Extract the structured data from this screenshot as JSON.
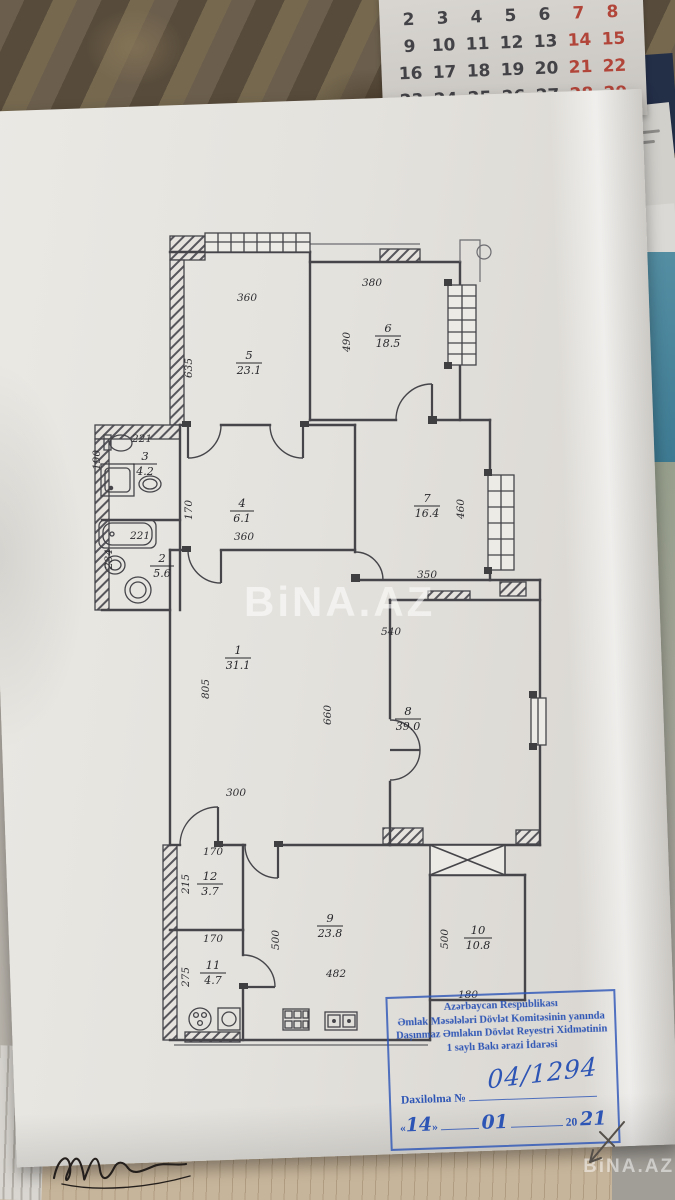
{
  "calendar": {
    "weeks": [
      [
        {
          "t": "2",
          "r": false
        },
        {
          "t": "3",
          "r": false
        },
        {
          "t": "4",
          "r": false
        },
        {
          "t": "5",
          "r": false
        },
        {
          "t": "6",
          "r": false
        },
        {
          "t": "7",
          "r": true
        },
        {
          "t": "8",
          "r": true
        }
      ],
      [
        {
          "t": "9",
          "r": false
        },
        {
          "t": "10",
          "r": false
        },
        {
          "t": "11",
          "r": false
        },
        {
          "t": "12",
          "r": false
        },
        {
          "t": "13",
          "r": false
        },
        {
          "t": "14",
          "r": true
        },
        {
          "t": "15",
          "r": true
        }
      ],
      [
        {
          "t": "16",
          "r": false
        },
        {
          "t": "17",
          "r": false
        },
        {
          "t": "18",
          "r": false
        },
        {
          "t": "19",
          "r": false
        },
        {
          "t": "20",
          "r": false
        },
        {
          "t": "21",
          "r": true
        },
        {
          "t": "22",
          "r": true
        }
      ],
      [
        {
          "t": "23",
          "r": false
        },
        {
          "t": "24",
          "r": false
        },
        {
          "t": "25",
          "r": false
        },
        {
          "t": "26",
          "r": false
        },
        {
          "t": "27",
          "r": false
        },
        {
          "t": "28",
          "r": true
        },
        {
          "t": "29",
          "r": true
        }
      ],
      [
        {
          "t": "30",
          "r": false
        },
        {
          "t": "31",
          "r": false
        },
        {
          "t": "",
          "r": false
        },
        {
          "t": "",
          "r": false
        },
        {
          "t": "",
          "r": false
        },
        {
          "t": "",
          "r": false
        },
        {
          "t": "",
          "r": false
        }
      ]
    ]
  },
  "side": {
    "note": "vev"
  },
  "watermarks": {
    "center": "BiNA.AZ",
    "corner": "BiNA.AZ"
  },
  "plan": {
    "rooms": [
      {
        "num": "1",
        "area": "31.1"
      },
      {
        "num": "2",
        "area": "5.6"
      },
      {
        "num": "3",
        "area": "4.2"
      },
      {
        "num": "4",
        "area": "6.1"
      },
      {
        "num": "5",
        "area": "23.1"
      },
      {
        "num": "6",
        "area": "18.5"
      },
      {
        "num": "7",
        "area": "16.4"
      },
      {
        "num": "8",
        "area": "39.0"
      },
      {
        "num": "9",
        "area": "23.8"
      },
      {
        "num": "10",
        "area": "10.8"
      },
      {
        "num": "11",
        "area": "4.7"
      },
      {
        "num": "12",
        "area": "3.7"
      }
    ],
    "dims": {
      "rm5_top": "360",
      "rm5_left": "635",
      "rm6_top": "380",
      "rm6_left": "490",
      "rm3_top": "221",
      "rm3_left": "190",
      "rm2_tub": "221",
      "rm2_left": "234",
      "rm4_left": "170",
      "rm4_bottom": "360",
      "rm7_right": "460",
      "rm7_bottom": "350",
      "rm1_left": "805",
      "rm1_mid": "660",
      "rm1_bottom": "300",
      "rm8_top": "540",
      "rm12_top": "170",
      "rm12_left": "215",
      "rm11_top": "170",
      "rm11_left": "275",
      "rm9_left": "500",
      "rm9_bottom": "482",
      "rm10_left": "500",
      "rm10_bottom": "180"
    }
  },
  "stamp": {
    "line1": "Azərbaycan Respublikası",
    "line2": "Əmlak Məsələləri Dövlət Komitəsinin yanında",
    "line3": "Daşınmaz Əmlakın Dövlət Reyestri Xidmətinin",
    "line4": "1 saylı Bakı ərazi İdarəsi",
    "daxilolma_label": "Daxilolma №",
    "reg_number": "04/1294",
    "open_quote": "«",
    "close_quote": "»",
    "day": "14",
    "month": "01",
    "year_prefix": "20",
    "year": "21"
  }
}
